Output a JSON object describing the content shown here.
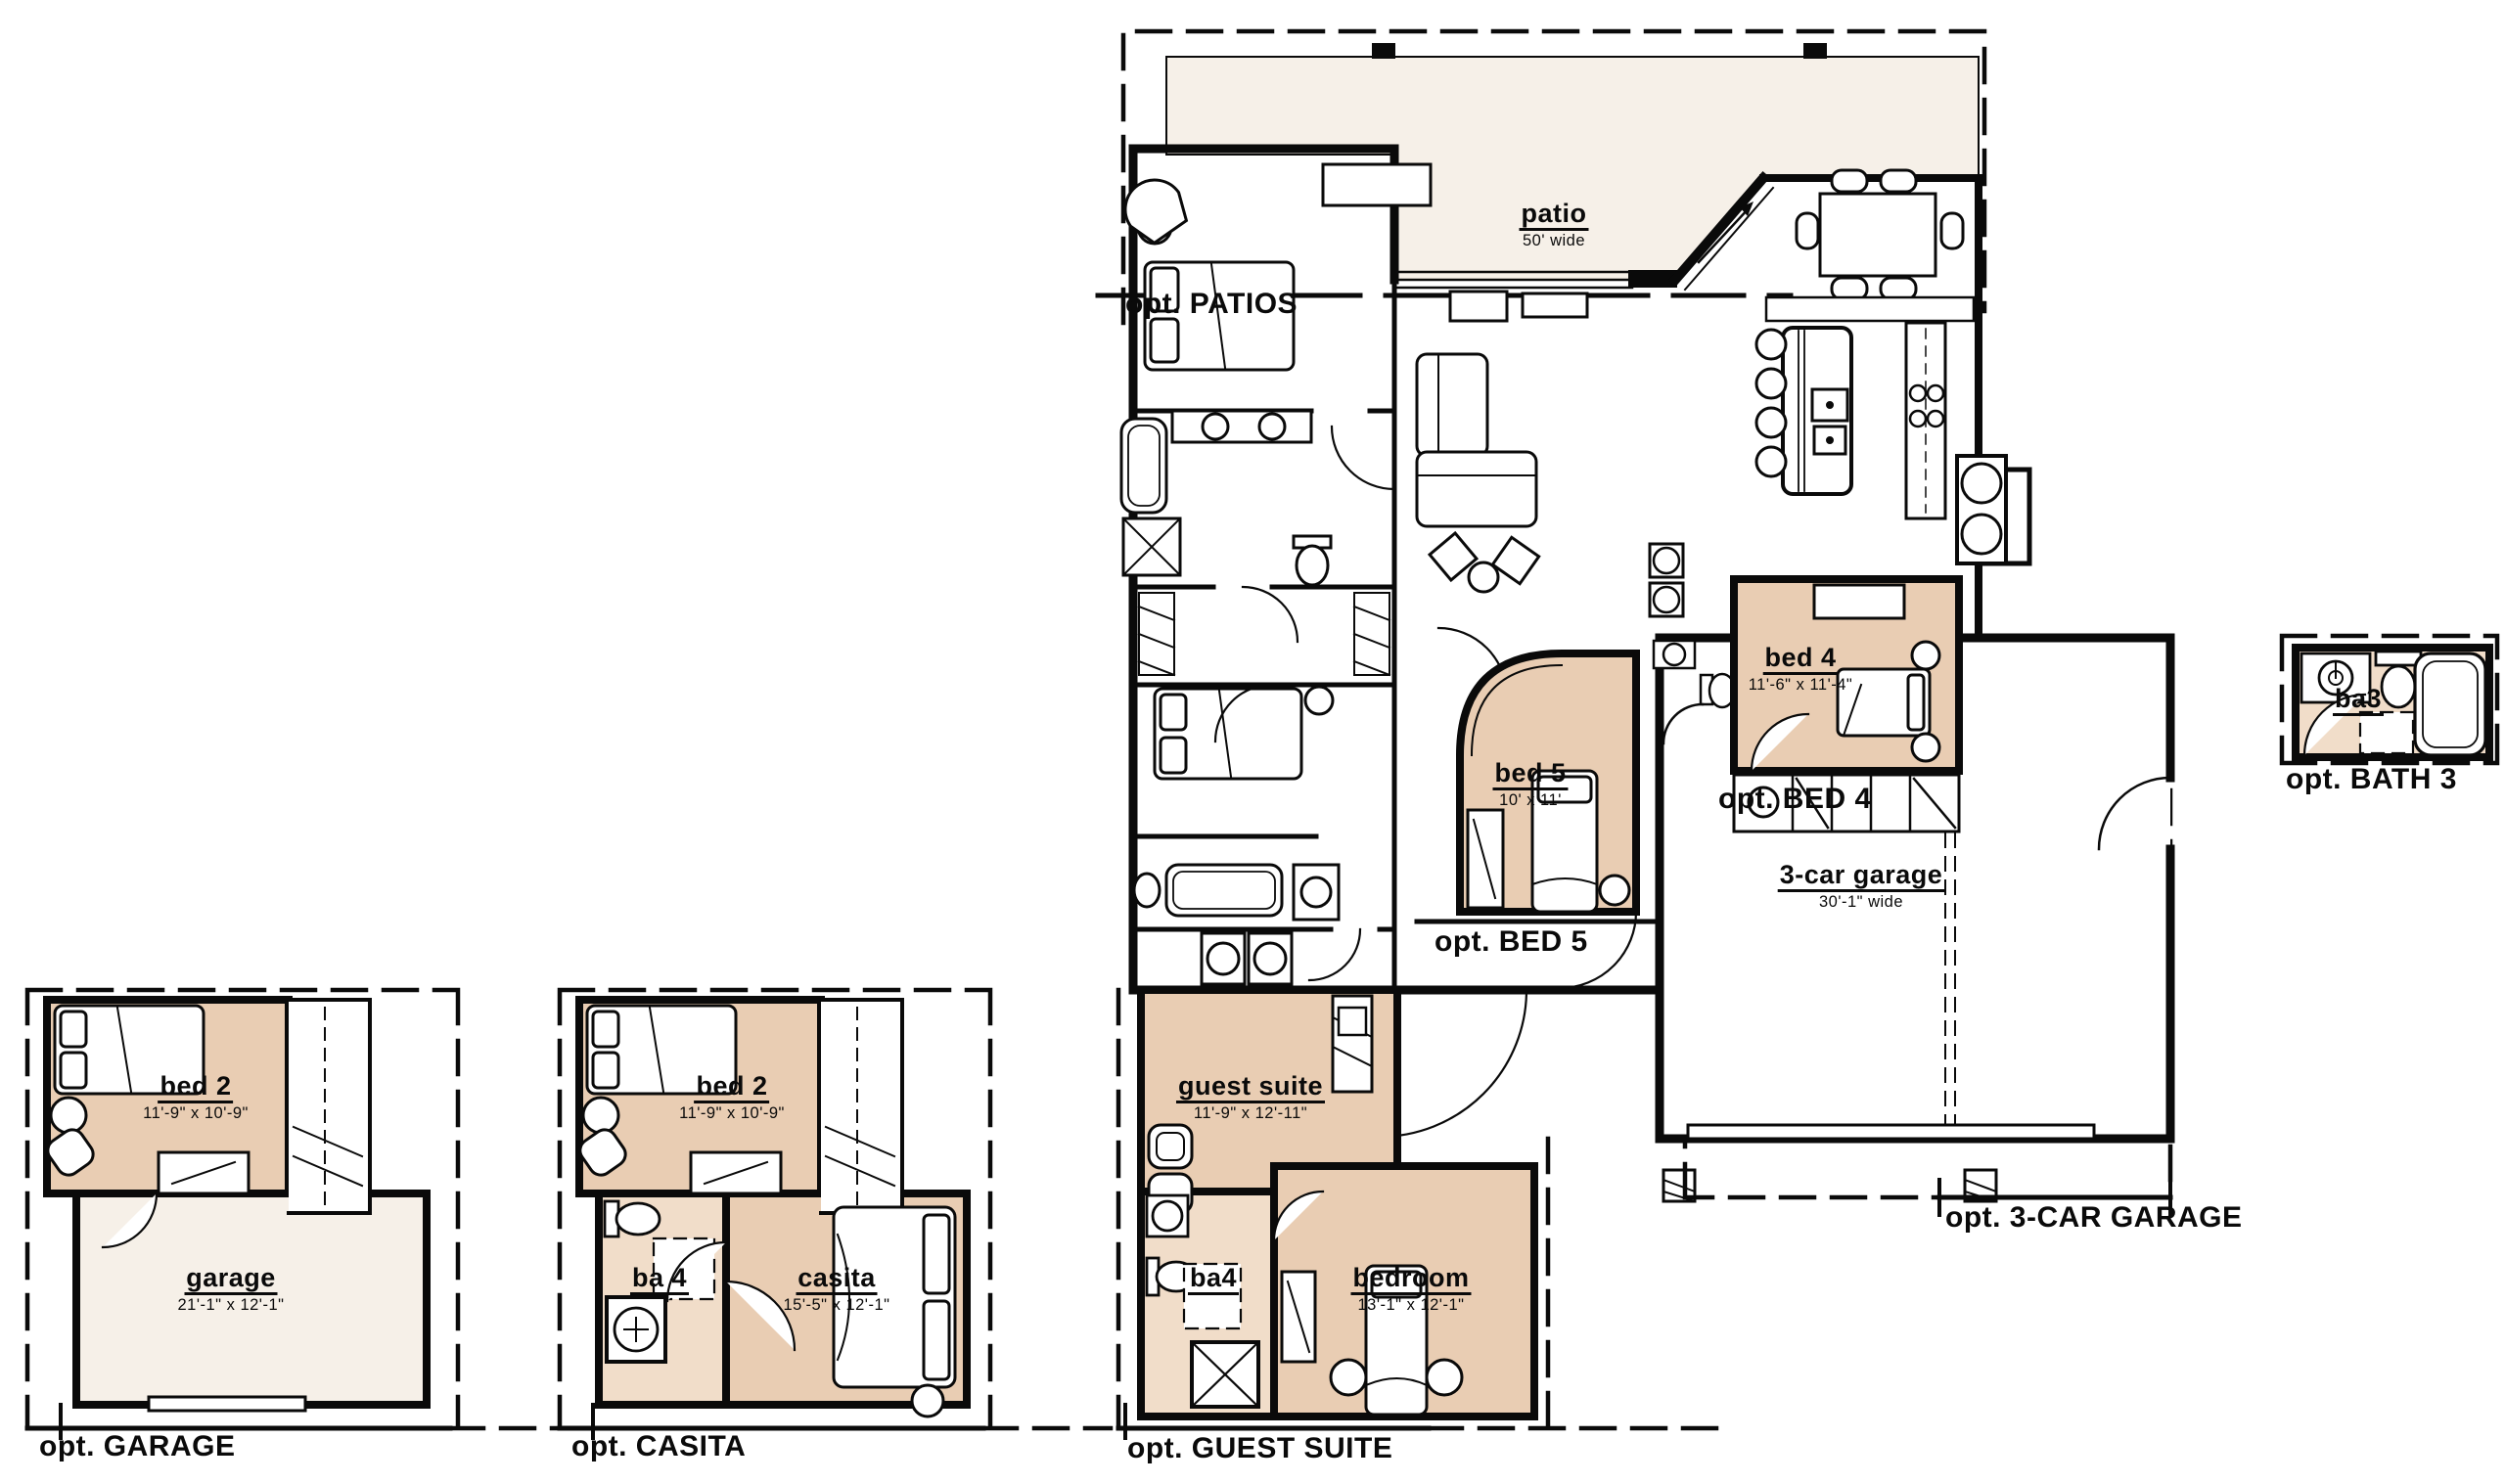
{
  "title": "floor plan with options",
  "colors": {
    "bedroom_fill": "#e9cdb3",
    "bath_fill": "#f1ddc9",
    "patio_fill": "#f6f0e8",
    "garage_fill": "#f6f0e8",
    "line": "#0a0a0a",
    "background": "#ffffff"
  },
  "main_plan": {
    "patio": {
      "name": "patio",
      "dims": "50' wide"
    },
    "opt_patios": "opt. PATIOS",
    "bed4": {
      "name": "bed 4",
      "dims": "11'-6\" x 11'-4\""
    },
    "opt_bed4": "opt. BED 4",
    "bed5": {
      "name": "bed 5",
      "dims": "10' x 11'"
    },
    "opt_bed5": "opt. BED 5",
    "garage3": {
      "name": "3-car garage",
      "dims": "30'-1\" wide"
    },
    "opt_3car": "opt. 3-CAR GARAGE"
  },
  "inset_garage": {
    "bed2": {
      "name": "bed 2",
      "dims": "11'-9\" x 10'-9\""
    },
    "garage": {
      "name": "garage",
      "dims": "21'-1\" x 12'-1\""
    },
    "opt": "opt. GARAGE"
  },
  "inset_casita": {
    "bed2": {
      "name": "bed 2",
      "dims": "11'-9\" x 10'-9\""
    },
    "ba4": {
      "name": "ba 4"
    },
    "casita": {
      "name": "casita",
      "dims": "15'-5\" x 12'-1\""
    },
    "opt": "opt. CASITA"
  },
  "inset_guest": {
    "guest_suite": {
      "name": "guest suite",
      "dims": "11'-9\" x 12'-11\""
    },
    "ba4": {
      "name": "ba4"
    },
    "bedroom": {
      "name": "bedroom",
      "dims": "13'-1\" x 12'-1\""
    },
    "opt": "opt. GUEST SUITE"
  },
  "inset_bath3": {
    "ba3": {
      "name": "ba3"
    },
    "opt": "opt. BATH 3"
  }
}
